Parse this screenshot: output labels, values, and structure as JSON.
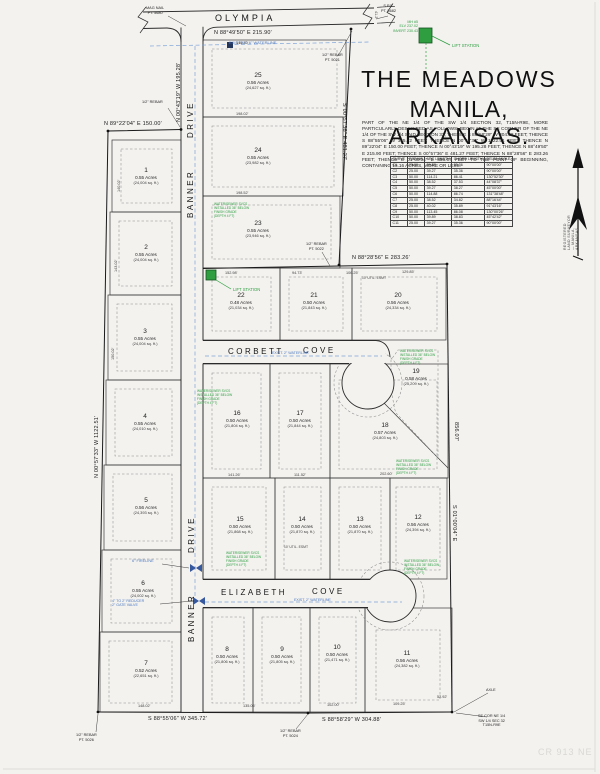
{
  "title": {
    "line1": "THE MEADOWS",
    "line2": "MANILA, ARKANSAS."
  },
  "legal_description": "PART OF THE NE 1/4 OF THE SW 1/4 SECTION 32, T15N-R9E, MORE PARTICULARLY DESCRIBED AS FOLLOWS: BEGIN AT THE SE CORNER OF THE NE 1/4 OF THE SW 1/4 SAID SECTION 32; THENCE S 88°58'29\" W 304.88 FEET; THENCE S 88°55'06\" W 345.72 FEET; THENCE N 00°57'33\" W 1122.51 FEET; THENCE N 89°22'04\" E 150.00 FEET; THENCE N 00°43'19\" W 195.28 FEET; THENCE N 88°49'50\" E 215.90 FEET; THENCE S 00°57'36\" E 481.27 FEET; THENCE N 88°28'56\" E 283.26 FEET; THENCE S 01°00'04\" E 856.07 FEET TO THE POINT OF BEGINNING, CONTAINING 15.16 ACRES, MORE OR LESS.",
  "curve_table": {
    "headers": [
      "CURVE",
      "RADIUS",
      "ARC LENGTH",
      "CHORD LENGTH",
      "DELTA ANGLE"
    ],
    "rows": [
      [
        "C1",
        "25.00",
        "39.27",
        "35.36",
        "90°00'00\""
      ],
      [
        "C2",
        "25.00",
        "39.27",
        "35.36",
        "90°00'00\""
      ],
      [
        "C3",
        "50.00",
        "114.21",
        "86.41",
        "130°52'30\""
      ],
      [
        "C4",
        "50.00",
        "38.52",
        "37.53",
        "44°08'37\""
      ],
      [
        "C5",
        "50.00",
        "39.27",
        "38.27",
        "45°00'00\""
      ],
      [
        "C6",
        "50.00",
        "114.88",
        "86.74",
        "131°38'48\""
      ],
      [
        "C7",
        "25.00",
        "38.52",
        "34.82",
        "88°16'44\""
      ],
      [
        "C8",
        "25.00",
        "40.02",
        "35.89",
        "91°43'16\""
      ],
      [
        "C9",
        "50.00",
        "113.45",
        "86.08",
        "130°00'26\""
      ],
      [
        "C10",
        "50.00",
        "39.89",
        "38.83",
        "45°42'42\""
      ],
      [
        "C11",
        "25.00",
        "39.27",
        "35.36",
        "90°00'00\""
      ]
    ]
  },
  "streets": {
    "olympia": "OLYMPIA",
    "banner": "BANNER",
    "drive": "DRIVE",
    "corbett": "CORBETT",
    "corbett_cove": "COVE",
    "elizabeth": "ELIZABETH",
    "elizabeth_cove": "COVE"
  },
  "bearings": {
    "olympia": "N 88°49'50\" E   215.90'",
    "banner_upper": "N 00°43'19\" W  195.28'",
    "west_jog": "N 89°22'04\" E  150.00'",
    "west": "N 00°57'33\" W  1122.51'",
    "east_upper": "S 00°57'36\" E  481.27'",
    "mid_east": "N 88°28'56\" E  283.26'",
    "east_dist": "856.07'",
    "east_lower": "S 01°00'04\" E",
    "bottom_left": "S 88°55'06\" W  345.72'",
    "bottom_right": "S 88°58'29\" W  304.88'"
  },
  "lots": [
    {
      "num": "1",
      "acres": "0.55 Acres",
      "sqft": "(24,004 sq. ft.)"
    },
    {
      "num": "2",
      "acres": "0.55 Acres",
      "sqft": "(24,004 sq. ft.)"
    },
    {
      "num": "3",
      "acres": "0.55 Acres",
      "sqft": "(24,004 sq. ft.)"
    },
    {
      "num": "4",
      "acres": "0.55 Acres",
      "sqft": "(24,010 sq. ft.)"
    },
    {
      "num": "5",
      "acres": "0.56 Acres",
      "sqft": "(24,393 sq. ft.)"
    },
    {
      "num": "6",
      "acres": "0.55 Acres",
      "sqft": "(24,002 sq. ft.)"
    },
    {
      "num": "7",
      "acres": "0.52 Acres",
      "sqft": "(22,651 sq. ft.)"
    },
    {
      "num": "8",
      "acres": "0.50 Acres",
      "sqft": "(21,806 sq. ft.)"
    },
    {
      "num": "9",
      "acres": "0.50 Acres",
      "sqft": "(21,805 sq. ft.)"
    },
    {
      "num": "10",
      "acres": "0.50 Acres",
      "sqft": "(21,471 sq. ft.)"
    },
    {
      "num": "11",
      "acres": "0.56 Acres",
      "sqft": "(24,382 sq. ft.)"
    },
    {
      "num": "12",
      "acres": "0.56 Acres",
      "sqft": "(24,394 sq. ft.)"
    },
    {
      "num": "13",
      "acres": "0.50 Acres",
      "sqft": "(21,870 sq. ft.)"
    },
    {
      "num": "14",
      "acres": "0.50 Acres",
      "sqft": "(21,870 sq. ft.)"
    },
    {
      "num": "15",
      "acres": "0.50 Acres",
      "sqft": "(21,868 sq. ft.)"
    },
    {
      "num": "16",
      "acres": "0.50 Acres",
      "sqft": "(21,804 sq. ft.)"
    },
    {
      "num": "17",
      "acres": "0.50 Acres",
      "sqft": "(21,844 sq. ft.)"
    },
    {
      "num": "18",
      "acres": "0.57 Acres",
      "sqft": "(24,803 sq. ft.)"
    },
    {
      "num": "19",
      "acres": "0.58 Acres",
      "sqft": "(25,209 sq. ft.)"
    },
    {
      "num": "20",
      "acres": "0.56 Acres",
      "sqft": "(24,334 sq. ft.)"
    },
    {
      "num": "21",
      "acres": "0.50 Acres",
      "sqft": "(21,843 sq. ft.)"
    },
    {
      "num": "22",
      "acres": "0.48 Acres",
      "sqft": "(21,034 sq. ft.)"
    },
    {
      "num": "23",
      "acres": "0.55 Acres",
      "sqft": "(23,946 sq. ft.)"
    },
    {
      "num": "24",
      "acres": "0.55 Acres",
      "sqft": "(23,982 sq. ft.)"
    },
    {
      "num": "25",
      "acres": "0.56 Acres",
      "sqft": "(24,627 sq. ft.)"
    }
  ],
  "points": {
    "mag_nail": "MAG NAIL",
    "mag_nail_pt": "PT. 5680",
    "sps": "S.P.S.",
    "sps_pt": "PT. 5682",
    "rebar": "1/2\" REBAR",
    "rebar_pt_5021": "PT. 5021",
    "rebar_pt_5022": "PT. 5022",
    "rebar_pt_5024": "PT. 5024",
    "rebar_pt_5026": "PT. 5026",
    "axle": "AXLE",
    "se_cor": [
      "SE COR NE 1/4",
      "SW 1/4 SEC 32",
      "T15N-R9E"
    ]
  },
  "notes": {
    "utility": [
      "WATER/SEWER SVCS",
      "INSTALLED 36\" BELOW",
      "FINISH GRADE",
      "(DEPTH 4 FT)"
    ],
    "lift_station": "LIFT STATION",
    "ls_detail": [
      "MH #5",
      "ELV 237.02",
      "INVERT 230.43"
    ],
    "existing_6wl": "EXISTING 6\" WATERLINE",
    "exist_2wl": "EXIST. 2\" WATERLINE",
    "fireline": "6\" FIRELINE",
    "reducer1": "4\" TO 2\" REDUCER",
    "reducer2": "2\" GATE VALVE",
    "util_esmt": "10' UTIL. ESMT"
  },
  "dims": [
    "146.70'",
    "198.02'",
    "198.52'",
    "152.98'",
    "94.73'",
    "106.25'",
    "129.85'",
    "141.26'",
    "111.52'",
    "202.60'",
    "148.02'",
    "135.06'",
    "102.00'",
    "109.25'",
    "52.92'",
    "140.02'",
    "143.02'",
    "150.02'",
    "41.2'"
  ],
  "watermark": "CR 913 NE",
  "stamp": "REGISTERED LAND SURVEYOR — MANILA, ARKANSAS"
}
